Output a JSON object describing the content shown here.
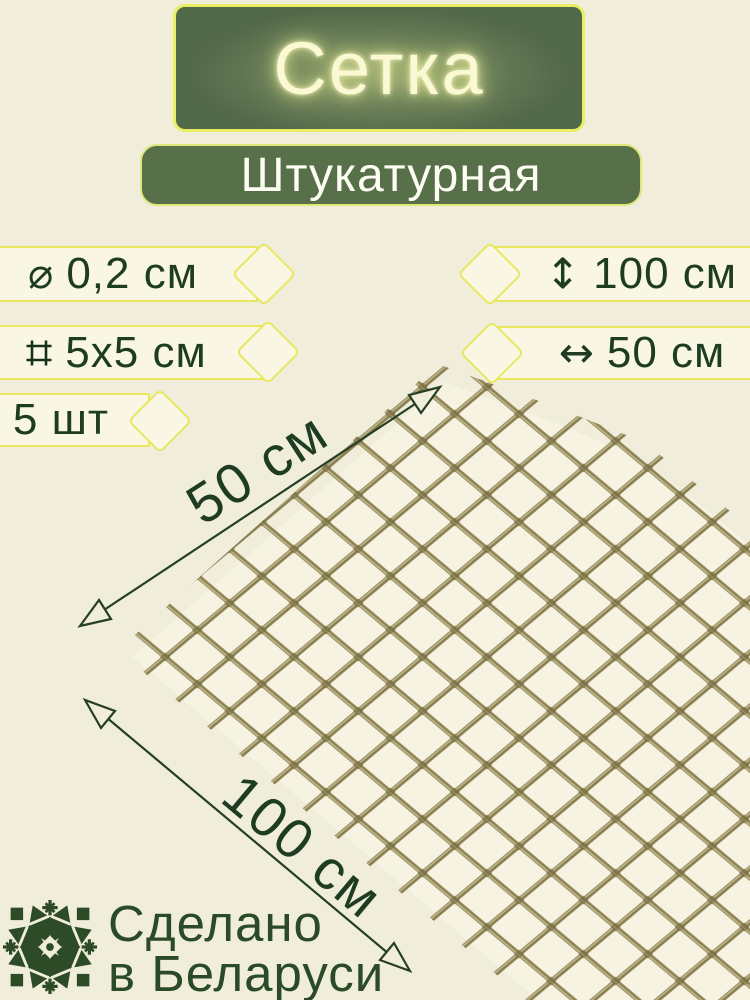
{
  "product": {
    "title": "Сетка",
    "subtitle": "Штукатурная"
  },
  "specs_left": [
    {
      "icon": "⌀",
      "label": "0,2 см"
    },
    {
      "icon": "square",
      "label": "5x5 см"
    },
    {
      "label": "5 шт"
    }
  ],
  "specs_right": [
    {
      "icon": "↕",
      "label": "100 см"
    },
    {
      "icon": "↔",
      "label": "50 см"
    }
  ],
  "dimensions": {
    "width": "50 см",
    "length": "100 см"
  },
  "origin": {
    "line1": "Сделано",
    "line2": "в Беларуси"
  },
  "colors": {
    "background": "#f0eedb",
    "banner_green": "#55704b",
    "accent_yellow": "#e8e75f",
    "text_dark_green": "#1e3c22",
    "mesh_thread": "#8d8352",
    "ornament_green": "#2d4b26"
  }
}
